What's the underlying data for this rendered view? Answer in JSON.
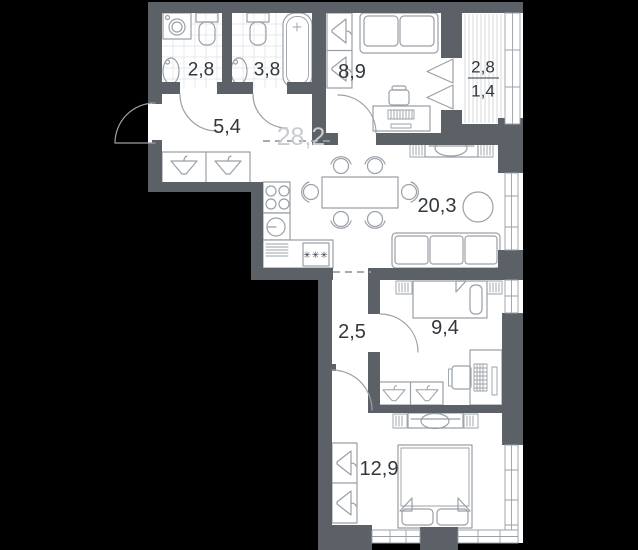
{
  "palette": {
    "bg": "#000000",
    "wall": "#5c6168",
    "floor": "#ffffff",
    "line": "#9aa0a7",
    "tile": "#dfe1e4",
    "deck": "#cdd0d4",
    "text": "#33373c",
    "text_faded": "#c8cbcf"
  },
  "plan": {
    "zone_total_area": "28,2",
    "fridge_symbol": "✳✳✳",
    "rooms": [
      {
        "id": "bathroom-small",
        "area": "2,8"
      },
      {
        "id": "bathroom-large",
        "area": "3,8"
      },
      {
        "id": "hallway",
        "area": "5,4"
      },
      {
        "id": "bedroom-top",
        "area": "8,9"
      },
      {
        "id": "loggia",
        "area_total": "2,8",
        "area_counted": "1,4"
      },
      {
        "id": "kitchen-living-room",
        "area": "20,3"
      },
      {
        "id": "corridor",
        "area": "2,5"
      },
      {
        "id": "bedroom-middle",
        "area": "9,4"
      },
      {
        "id": "bedroom-main",
        "area": "12,9"
      }
    ]
  }
}
